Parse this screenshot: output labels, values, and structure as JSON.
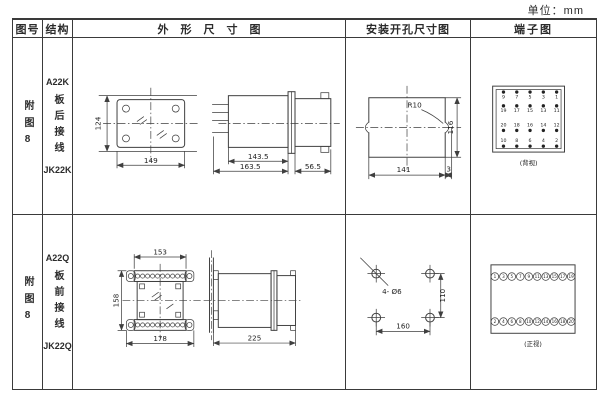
{
  "unit_label": "单位：mm",
  "header": {
    "col_figure": "图号",
    "col_structure": "结构",
    "col_outline": "外形尺寸图",
    "col_mounting": "安装开孔尺寸图",
    "col_terminal": "端子图"
  },
  "rows": [
    {
      "figure_no": "附图8",
      "structure": {
        "model_top": "A22K",
        "wiring": "板后接线",
        "model_bottom": "JK22K"
      },
      "outline": {
        "front": {
          "height": "124",
          "width": "149"
        },
        "side": {
          "case_depth": "143.5",
          "total_depth": "163.5",
          "rear_depth": "56.5"
        }
      },
      "mounting": {
        "radius": "R10",
        "width": "141",
        "height": "116",
        "offset": "3"
      },
      "terminal": {
        "view_label": "(背视)",
        "grid": [
          [
            "9",
            "7",
            "5",
            "3",
            "1"
          ],
          [
            "19",
            "17",
            "15",
            "13",
            "11"
          ],
          [
            "20",
            "18",
            "16",
            "14",
            "12"
          ],
          [
            "10",
            "8",
            "6",
            "4",
            "2"
          ]
        ]
      }
    },
    {
      "figure_no": "附图8",
      "structure": {
        "model_top": "A22Q",
        "wiring": "板前接线",
        "model_bottom": "JK22Q"
      },
      "outline": {
        "front": {
          "top_width": "153",
          "height": "158",
          "bottom_width": "178"
        },
        "side": {
          "depth": "225"
        }
      },
      "mounting": {
        "holes": "4- Ø6",
        "width": "160",
        "height": "110"
      },
      "terminal": {
        "view_label": "(正视)",
        "top_row": [
          "1",
          "3",
          "5",
          "7",
          "9",
          "11",
          "13",
          "15",
          "17",
          "19"
        ],
        "bottom_row": [
          "2",
          "4",
          "6",
          "8",
          "10",
          "12",
          "14",
          "16",
          "18",
          "20"
        ]
      }
    }
  ]
}
